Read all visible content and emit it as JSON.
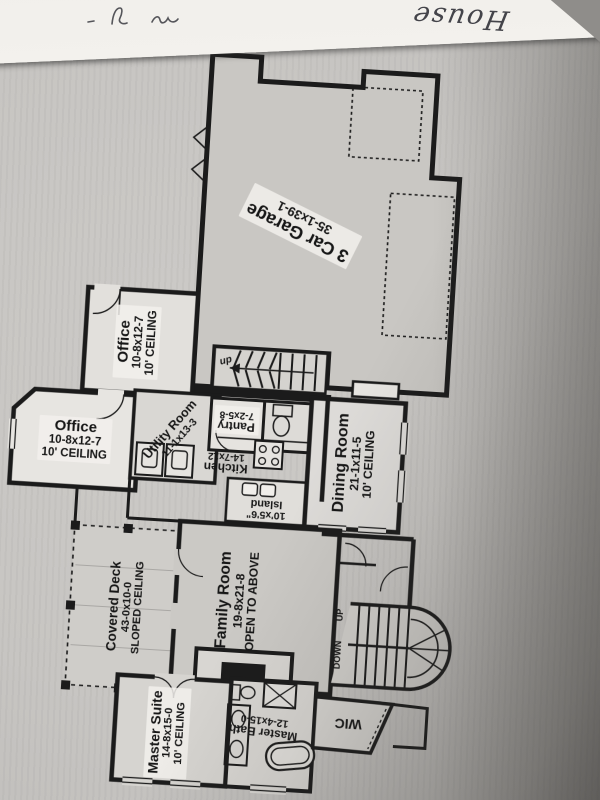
{
  "handwriting": {
    "title": "House"
  },
  "rooms": {
    "garage": {
      "name": "3 Car Garage",
      "dims": "35-1x39-1"
    },
    "office_upper": {
      "name": "Office",
      "dims": "10-8x12-7",
      "ceiling": "10' CEILING"
    },
    "office_left": {
      "name": "Office",
      "dims": "10-8x12-7",
      "ceiling": "10' CEILING"
    },
    "utility": {
      "name": "Utility Room",
      "dims": "11-1x13-3"
    },
    "pantry": {
      "name": "Pantry",
      "dims": "7-2x5-8"
    },
    "kitchen": {
      "name": "Kitchen",
      "dims": "14-7x12"
    },
    "island": {
      "name": "Island",
      "dims": "10'x5'6\""
    },
    "dining": {
      "name": "Dining Room",
      "dims": "21-1x11-5",
      "ceiling": "10' CEILING"
    },
    "deck": {
      "name": "Covered Deck",
      "dims": "43-0x10-0",
      "ceiling": "SLOPED CEILING"
    },
    "family": {
      "name": "Family Room",
      "dims": "19-8x21-8",
      "note": "OPEN TO ABOVE"
    },
    "master": {
      "name": "Master Suite",
      "dims": "14-8x15-0",
      "ceiling": "10' CEILING"
    },
    "master_bath": {
      "name": "Master Bath",
      "dims": "12-4x15-0"
    },
    "wic": {
      "name": "WIC"
    }
  },
  "stairs": {
    "down": "DOWN",
    "up": "UP",
    "garage_stair": "up"
  },
  "colors": {
    "paper_white": "#f2f0ec",
    "sheet_gray": "#c6c4c1",
    "ink": "#1b1b1b",
    "pencil": "#44444a"
  }
}
